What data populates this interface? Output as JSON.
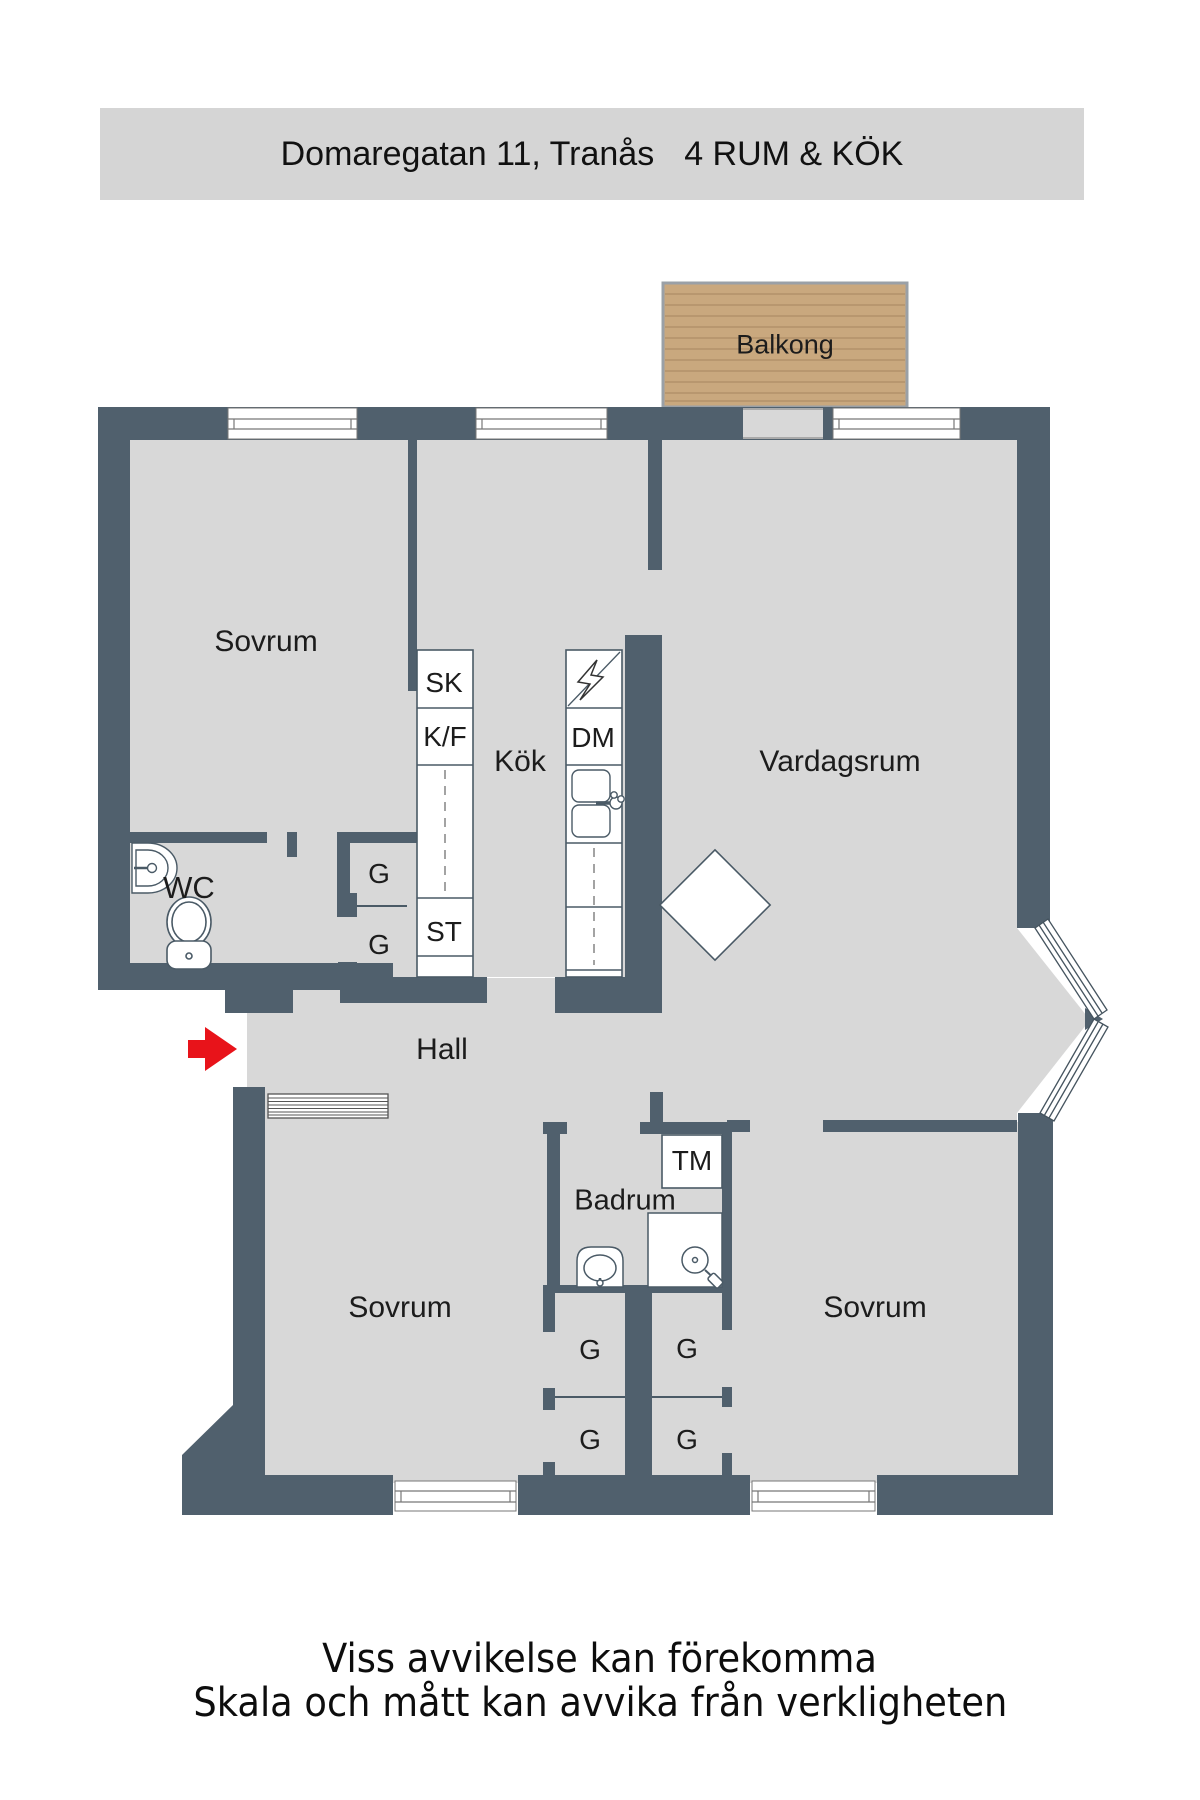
{
  "header": {
    "address": "Domaregatan 11, Tranås",
    "rooms_spec": "4 RUM & KÖK"
  },
  "plan": {
    "rooms": {
      "balcony": "Balkong",
      "bedroom": "Sovrum",
      "kitchen": "Kök",
      "living_room": "Vardagsrum",
      "wc": "WC",
      "hall": "Hall",
      "bathroom": "Badrum"
    },
    "fixtures": {
      "cleaning_closet": "SK",
      "fridge_freezer": "K/F",
      "dishwasher": "DM",
      "pantry": "ST",
      "washing_machine": "TM",
      "wardrobe": "G"
    }
  },
  "footer": {
    "line1": "Viss avvikelse kan förekomma",
    "line2": "Skala och mått kan avvika från verkligheten"
  },
  "colors": {
    "wall": "#50606d",
    "floor": "#d8d8d8",
    "balcony_wood": "#c9a87e",
    "header_bar": "#d5d5d5",
    "entrance_arrow": "#e8131a"
  }
}
